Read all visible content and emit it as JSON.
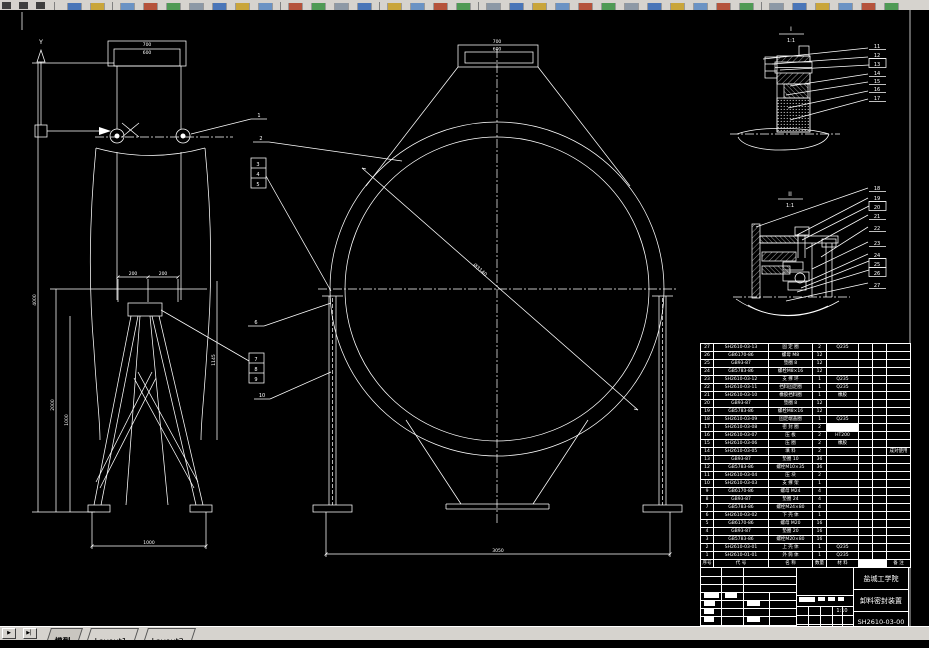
{
  "window": {
    "tab_nav_next": "▶",
    "tab_nav_last": "▶▏",
    "tabs": [
      {
        "label": "模型",
        "active": true
      },
      {
        "label": "Layout1",
        "active": false
      },
      {
        "label": "Layout2",
        "active": false
      }
    ]
  },
  "drawing": {
    "axis": {
      "y_label": "Y"
    },
    "dims_left": {
      "inlet_outer": "700",
      "inlet_inner": "600",
      "flange_left": "200",
      "flange_right": "200",
      "base_width": "1000",
      "height_total": "4000",
      "height_stand": "2000",
      "height_upper": "1000",
      "height_right": "1145"
    },
    "dims_front": {
      "inlet_outer": "700",
      "inlet_inner": "600",
      "diameter": "Ø3140",
      "base_width": "3050"
    },
    "details": {
      "d1": {
        "label": "I",
        "scale": "1:1"
      },
      "d2": {
        "label": "II",
        "scale": "1:1"
      }
    },
    "balloons": [
      "1",
      "2",
      "3",
      "4",
      "5",
      "6",
      "7",
      "8",
      "9",
      "10",
      "11",
      "12",
      "13",
      "14",
      "15",
      "16",
      "17",
      "18",
      "19",
      "20",
      "21",
      "22",
      "23",
      "24",
      "25",
      "26",
      "27"
    ]
  },
  "parts_table": {
    "header": [
      "序号",
      "代  号",
      "名  称",
      "数量",
      "材  料",
      "□",
      "□",
      "备 注"
    ],
    "rows": [
      [
        "27",
        "SH2610-03-13",
        "固 定 圈",
        "2",
        "Q235",
        "",
        "",
        ""
      ],
      [
        "26",
        "GB6170-86",
        "螺母 M8",
        "12",
        "",
        "",
        "",
        ""
      ],
      [
        "25",
        "GB93-87",
        "垫圈 8",
        "12",
        "",
        "",
        "",
        ""
      ],
      [
        "24",
        "GB5783-86",
        "螺栓M8×16",
        "12",
        "",
        "",
        "",
        ""
      ],
      [
        "23",
        "SH2610-03-12",
        "支 撑 环",
        "1",
        "Q235",
        "",
        "",
        ""
      ],
      [
        "22",
        "SH2610-03-11",
        "挡料固定圈",
        "1",
        "Q235",
        "",
        "",
        ""
      ],
      [
        "21",
        "SH2610-03-10",
        "橡胶挡料圈",
        "1",
        "橡胶",
        "",
        "",
        ""
      ],
      [
        "20",
        "GB93-87",
        "垫圈 8",
        "12",
        "",
        "",
        "",
        ""
      ],
      [
        "19",
        "GB5783-86",
        "螺栓M8×16",
        "12",
        "",
        "",
        "",
        ""
      ],
      [
        "18",
        "SH2610-03-09",
        "固定端盖圈",
        "1",
        "Q235",
        "",
        "",
        ""
      ],
      [
        "17",
        "SH2610-03-08",
        "密 封 圈",
        "2",
        "□",
        "",
        "",
        ""
      ],
      [
        "16",
        "SH2610-03-07",
        "压  板",
        "2",
        "HT200",
        "",
        "",
        ""
      ],
      [
        "15",
        "SH2610-03-06",
        "压  圈",
        "2",
        "橡胶",
        "",
        "",
        ""
      ],
      [
        "14",
        "SH2610-03-05",
        "填  料",
        "2",
        "",
        "",
        "",
        "成对使用"
      ],
      [
        "13",
        "GB93-87",
        "垫圈 10",
        "36",
        "",
        "",
        "",
        ""
      ],
      [
        "12",
        "GB5783-86",
        "螺栓M10×35",
        "36",
        "",
        "",
        "",
        ""
      ],
      [
        "11",
        "SH2610-03-04",
        "压  块",
        "2",
        "",
        "",
        "",
        ""
      ],
      [
        "10",
        "SH2610-03-03",
        "支 撑 架",
        "1",
        "",
        "",
        "",
        ""
      ],
      [
        "9",
        "GB6170-86",
        "螺母 M24",
        "4",
        "",
        "",
        "",
        ""
      ],
      [
        "8",
        "GB93-87",
        "垫圈 24",
        "4",
        "",
        "",
        "",
        ""
      ],
      [
        "7",
        "GB5783-86",
        "螺栓M24×80",
        "4",
        "",
        "",
        "",
        ""
      ],
      [
        "6",
        "SH2610-03-02",
        "下 壳 体",
        "1",
        "",
        "",
        "",
        ""
      ],
      [
        "5",
        "GB6170-86",
        "螺母 M20",
        "16",
        "",
        "",
        "",
        ""
      ],
      [
        "4",
        "GB93-87",
        "垫圈 20",
        "16",
        "",
        "",
        "",
        ""
      ],
      [
        "3",
        "GB5783-86",
        "螺栓M20×80",
        "16",
        "",
        "",
        "",
        ""
      ],
      [
        "2",
        "SH2610-03-01",
        "上 壳 体",
        "1",
        "Q235",
        "",
        "",
        ""
      ],
      [
        "1",
        "SH2610-01-01",
        "外 筒 体",
        "1",
        "Q235",
        "",
        "",
        ""
      ]
    ]
  },
  "title_block": {
    "school": "盐城工学院",
    "product": "卸料密封装置",
    "drawing_no": "SH2610-03-00",
    "scale": "1:10",
    "sheet_total": "1",
    "sheet_current": "1"
  }
}
